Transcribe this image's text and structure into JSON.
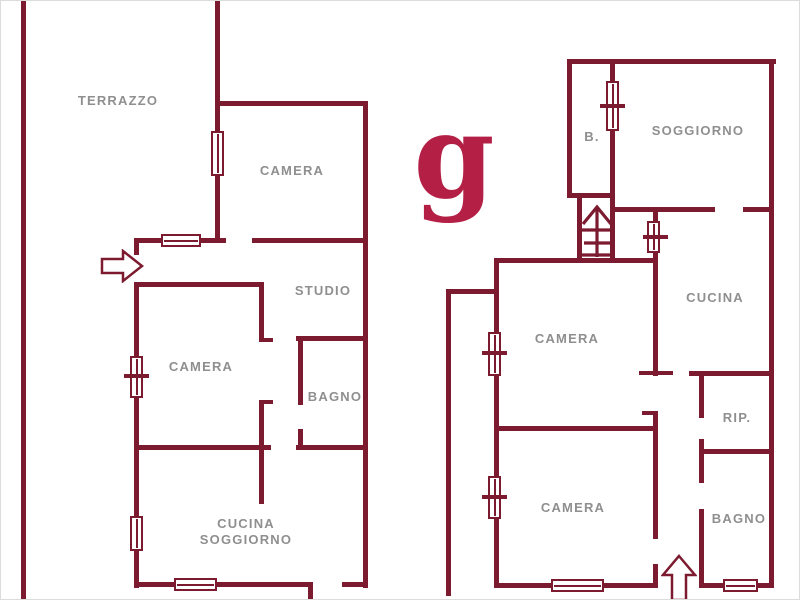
{
  "colors": {
    "wall_maroon": "#7c1b2f",
    "label_gray": "#8f8f8f",
    "logo_crimson": "#b42045",
    "background": "#ffffff"
  },
  "logo": {
    "letter": "g"
  },
  "room_labels": [
    {
      "id": "terrazzo",
      "text": "TERRAZZO",
      "x": 117,
      "y": 100
    },
    {
      "id": "camera-1",
      "text": "CAMERA",
      "x": 291,
      "y": 170
    },
    {
      "id": "studio",
      "text": "STUDIO",
      "x": 322,
      "y": 290
    },
    {
      "id": "camera-2",
      "text": "CAMERA",
      "x": 200,
      "y": 366
    },
    {
      "id": "bagno-1",
      "text": "BAGNO",
      "x": 334,
      "y": 396
    },
    {
      "id": "cucina-soggiorno",
      "text": "CUCINA\nSOGGIORNO",
      "x": 245,
      "y": 531
    },
    {
      "id": "b",
      "text": "B.",
      "x": 591,
      "y": 136
    },
    {
      "id": "soggiorno",
      "text": "SOGGIORNO",
      "x": 697,
      "y": 130
    },
    {
      "id": "cucina",
      "text": "CUCINA",
      "x": 714,
      "y": 297
    },
    {
      "id": "camera-3",
      "text": "CAMERA",
      "x": 566,
      "y": 338
    },
    {
      "id": "rip",
      "text": "RIP.",
      "x": 736,
      "y": 417
    },
    {
      "id": "camera-4",
      "text": "CAMERA",
      "x": 572,
      "y": 507
    },
    {
      "id": "bagno-2",
      "text": "BAGNO",
      "x": 738,
      "y": 518
    }
  ],
  "symbols": {
    "entrance_left": "right-arrow-entrance",
    "entrance_bottom": "up-arrow-entrance",
    "staircase": "stairs-up-arrow"
  }
}
